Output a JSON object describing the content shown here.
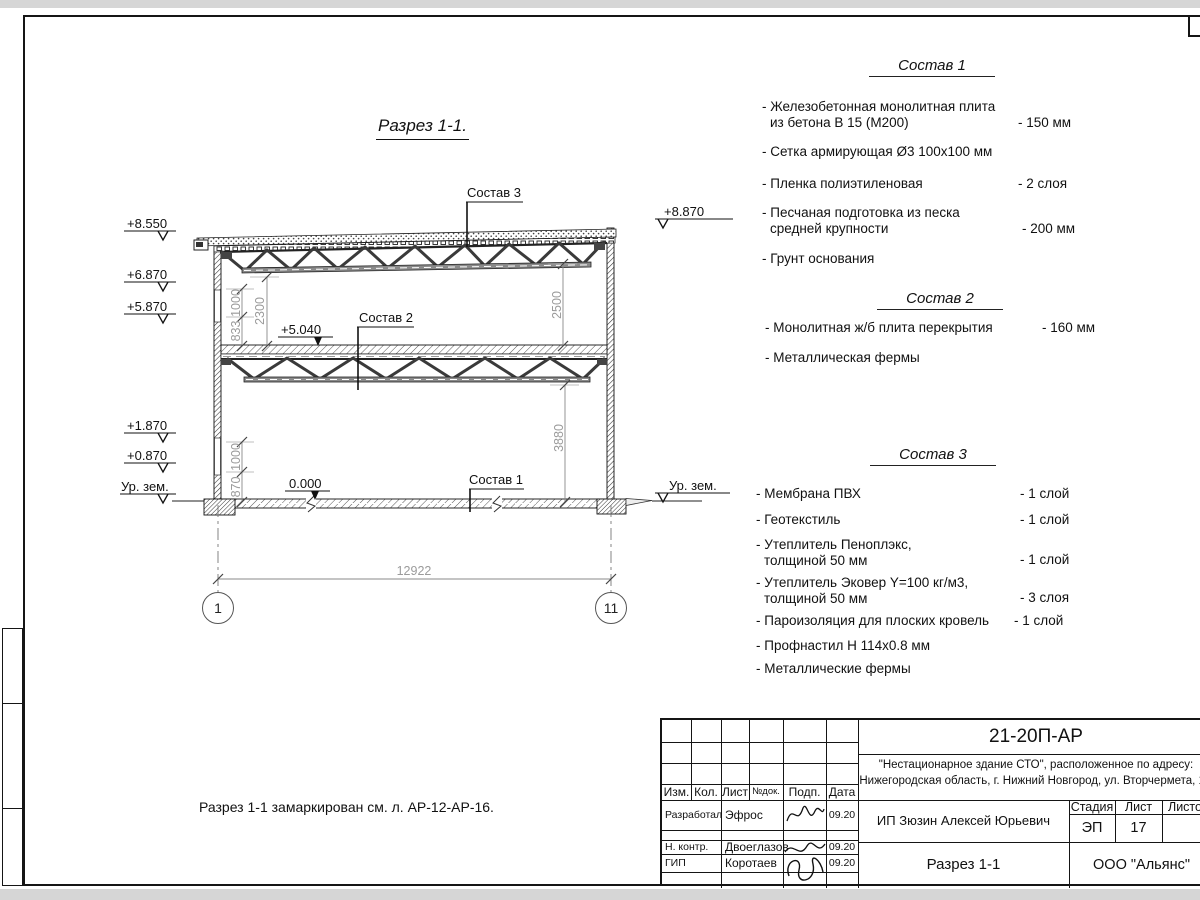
{
  "page": {
    "title": "Разрез 1-1.",
    "note": "Разрез 1-1 замаркирован см. л. АР-12-АР-16."
  },
  "drawing": {
    "elevations_left": [
      "+8.550",
      "+6.870",
      "+5.870",
      "+1.870",
      "+0.870",
      "Ур. зем."
    ],
    "elevations_right": [
      "+8.870",
      "Ур. зем."
    ],
    "level_marks": [
      "+5.040",
      "0.000"
    ],
    "callouts": [
      "Состав 3",
      "Состав 2",
      "Состав 1"
    ],
    "dims": {
      "v1": "1000",
      "v2": "833",
      "v3": "2300",
      "v4": "1000",
      "v5": "870",
      "v6": "2500",
      "v7": "3880",
      "h1": "12922"
    },
    "axes": [
      "1",
      "11"
    ]
  },
  "compositions": [
    {
      "heading": "Состав 1",
      "items": [
        {
          "line1": "- Железобетонная  монолитная плита",
          "line2": "из бетона В 15 (М200)",
          "value": "- 150 мм"
        },
        {
          "line1": "- Сетка армирующая Ø3 100х100 мм",
          "line2": "",
          "value": ""
        },
        {
          "line1": "- Пленка полиэтиленовая",
          "line2": "",
          "value": "- 2 слоя"
        },
        {
          "line1": "- Песчаная подготовка из песка",
          "line2": "средней крупности",
          "value": "- 200 мм"
        },
        {
          "line1": "- Грунт основания",
          "line2": "",
          "value": ""
        }
      ]
    },
    {
      "heading": "Состав 2",
      "items": [
        {
          "line1": "- Монолитная ж/б плита перекрытия",
          "line2": "",
          "value": "- 160 мм"
        },
        {
          "line1": "- Металлическая фермы",
          "line2": "",
          "value": ""
        }
      ]
    },
    {
      "heading": "Состав 3",
      "items": [
        {
          "line1": "- Мембрана ПВХ",
          "line2": "",
          "value": "- 1 слой"
        },
        {
          "line1": "- Геотекстиль",
          "line2": "",
          "value": "- 1 слой"
        },
        {
          "line1": "- Утеплитель Пеноплэкс,",
          "line2": "толщиной 50 мм",
          "value": "- 1 слой"
        },
        {
          "line1": "- Утеплитель Эковер Y=100 кг/м3,",
          "line2": "толщиной 50 мм",
          "value": "- 3 слоя"
        },
        {
          "line1": "- Пароизоляция для плоских кровель",
          "line2": "",
          "value": "- 1 слой"
        },
        {
          "line1": "- Профнастил Н 114х0.8 мм",
          "line2": "",
          "value": ""
        },
        {
          "line1": "- Металлические фермы",
          "line2": "",
          "value": ""
        }
      ]
    }
  ],
  "titleblock": {
    "doc_number": "21-20П-АР",
    "project_line1": "\"Нестационарное здание СТО\", расположенное по адресу:",
    "project_line2": "Нижегородская область, г. Нижний Новгород, ул. Вторчермета, 1А",
    "client": "ИП Зюзин Алексей Юрьевич",
    "drawing_name": "Разрез 1-1",
    "company": "ООО \"Альянс\"",
    "stage_label": "Стадия",
    "sheet_label": "Лист",
    "sheets_label": "Листов",
    "stage": "ЭП",
    "sheet_number": "17",
    "columns": [
      "Изм.",
      "Кол.",
      "Лист",
      "№док.",
      "Подп.",
      "Дата"
    ],
    "rows": [
      {
        "role": "Разработал",
        "name": "Эфрос",
        "date": "09.20"
      },
      {
        "role": "Н. контр.",
        "name": "Двоеглазов",
        "date": "09.20"
      },
      {
        "role": "ГИП",
        "name": "Коротаев",
        "date": "09.20"
      }
    ]
  }
}
